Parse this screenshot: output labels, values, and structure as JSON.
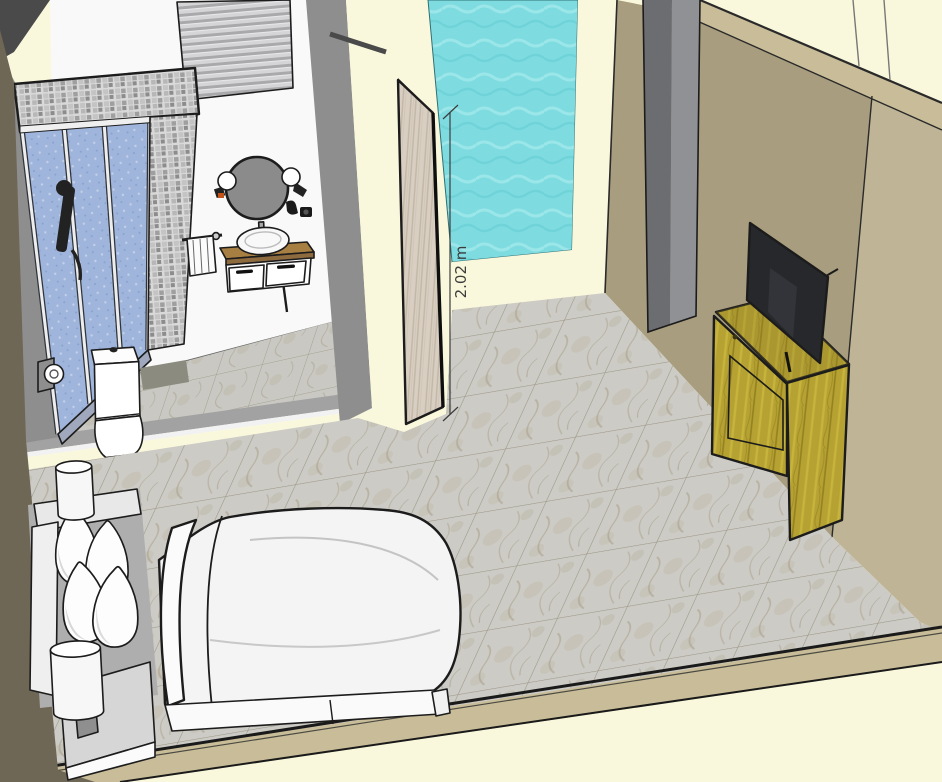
{
  "viewport": {
    "type": "3d-model-viewport",
    "scene": "hotel-room-interior-with-bathroom",
    "annotation": {
      "dimension_label": "2.02 m"
    }
  },
  "objects": [
    "window-blinds",
    "shower-enclosure",
    "shower-fixture",
    "toilet",
    "toilet-paper-holder",
    "bath-mat",
    "round-mirror",
    "globe-wall-lamps",
    "wall-hooks",
    "towel-rail",
    "vanity-cabinet",
    "vessel-sink",
    "open-wood-door",
    "dimension-annotation",
    "glass-panel",
    "interior-gray-door",
    "tv",
    "tv-console",
    "telephone",
    "bed",
    "pillows",
    "headboard",
    "nightstand",
    "table-lamps",
    "marble-tile-floor"
  ],
  "palette": {
    "cream": "#FAF8DC",
    "wall_white": "#F9F9F9",
    "wall_gray": "#8E8E8E",
    "taupe": "#6F6756",
    "tan_dark": "#A89D7E",
    "tan_light": "#BFB596",
    "khaki": "#C9BD99",
    "cyan": "#7EDCE1",
    "glass": "#9FB5DC",
    "marble": "#CCCBC5",
    "grout": "#8F8774",
    "door_wood": "#D8CFC2",
    "olive": "#B6A233",
    "olive_mid": "#A08D26",
    "olive_dark": "#453F1D",
    "counter": "#A87F42",
    "tv": "#26282B",
    "bed_white": "#F4F4F4",
    "shade": "#D8D8D8",
    "gray_mid": "#AEAEAE",
    "mirror": "#8B8B8B",
    "outline": "#1C1C1C",
    "dim": "#3C3C3C",
    "threshold": "#A2A2A2",
    "mat": "#8B8B80",
    "door_gray_l": "#6B6D70",
    "door_gray_r": "#8F9195"
  }
}
